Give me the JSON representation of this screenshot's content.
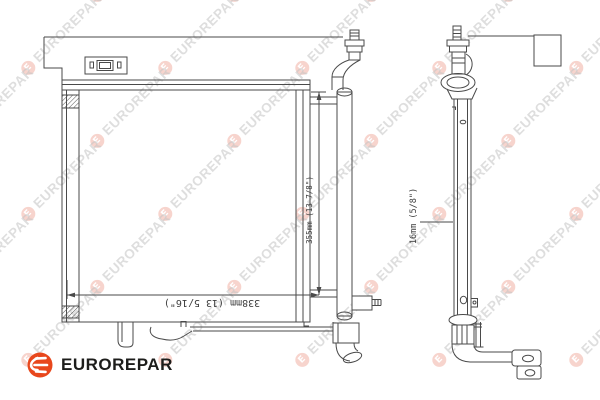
{
  "watermark": {
    "text": "EUROREPAR",
    "logo_letter": "E",
    "text_color": "#c4c4c4",
    "logo_bg": "#f2b1a6",
    "opacity": 0.55,
    "rows": 6,
    "cols": 5
  },
  "brand": {
    "name": "EUROREPAR",
    "icon_bg": "#e8471c",
    "text_color": "#1d1d1b"
  },
  "drawing": {
    "line_color": "#4a4a4a",
    "dimensions": {
      "width": "338mm (13 5/16\")",
      "height": "355mm (13 7/8\")",
      "depth": "16mm (5/8\")"
    }
  }
}
